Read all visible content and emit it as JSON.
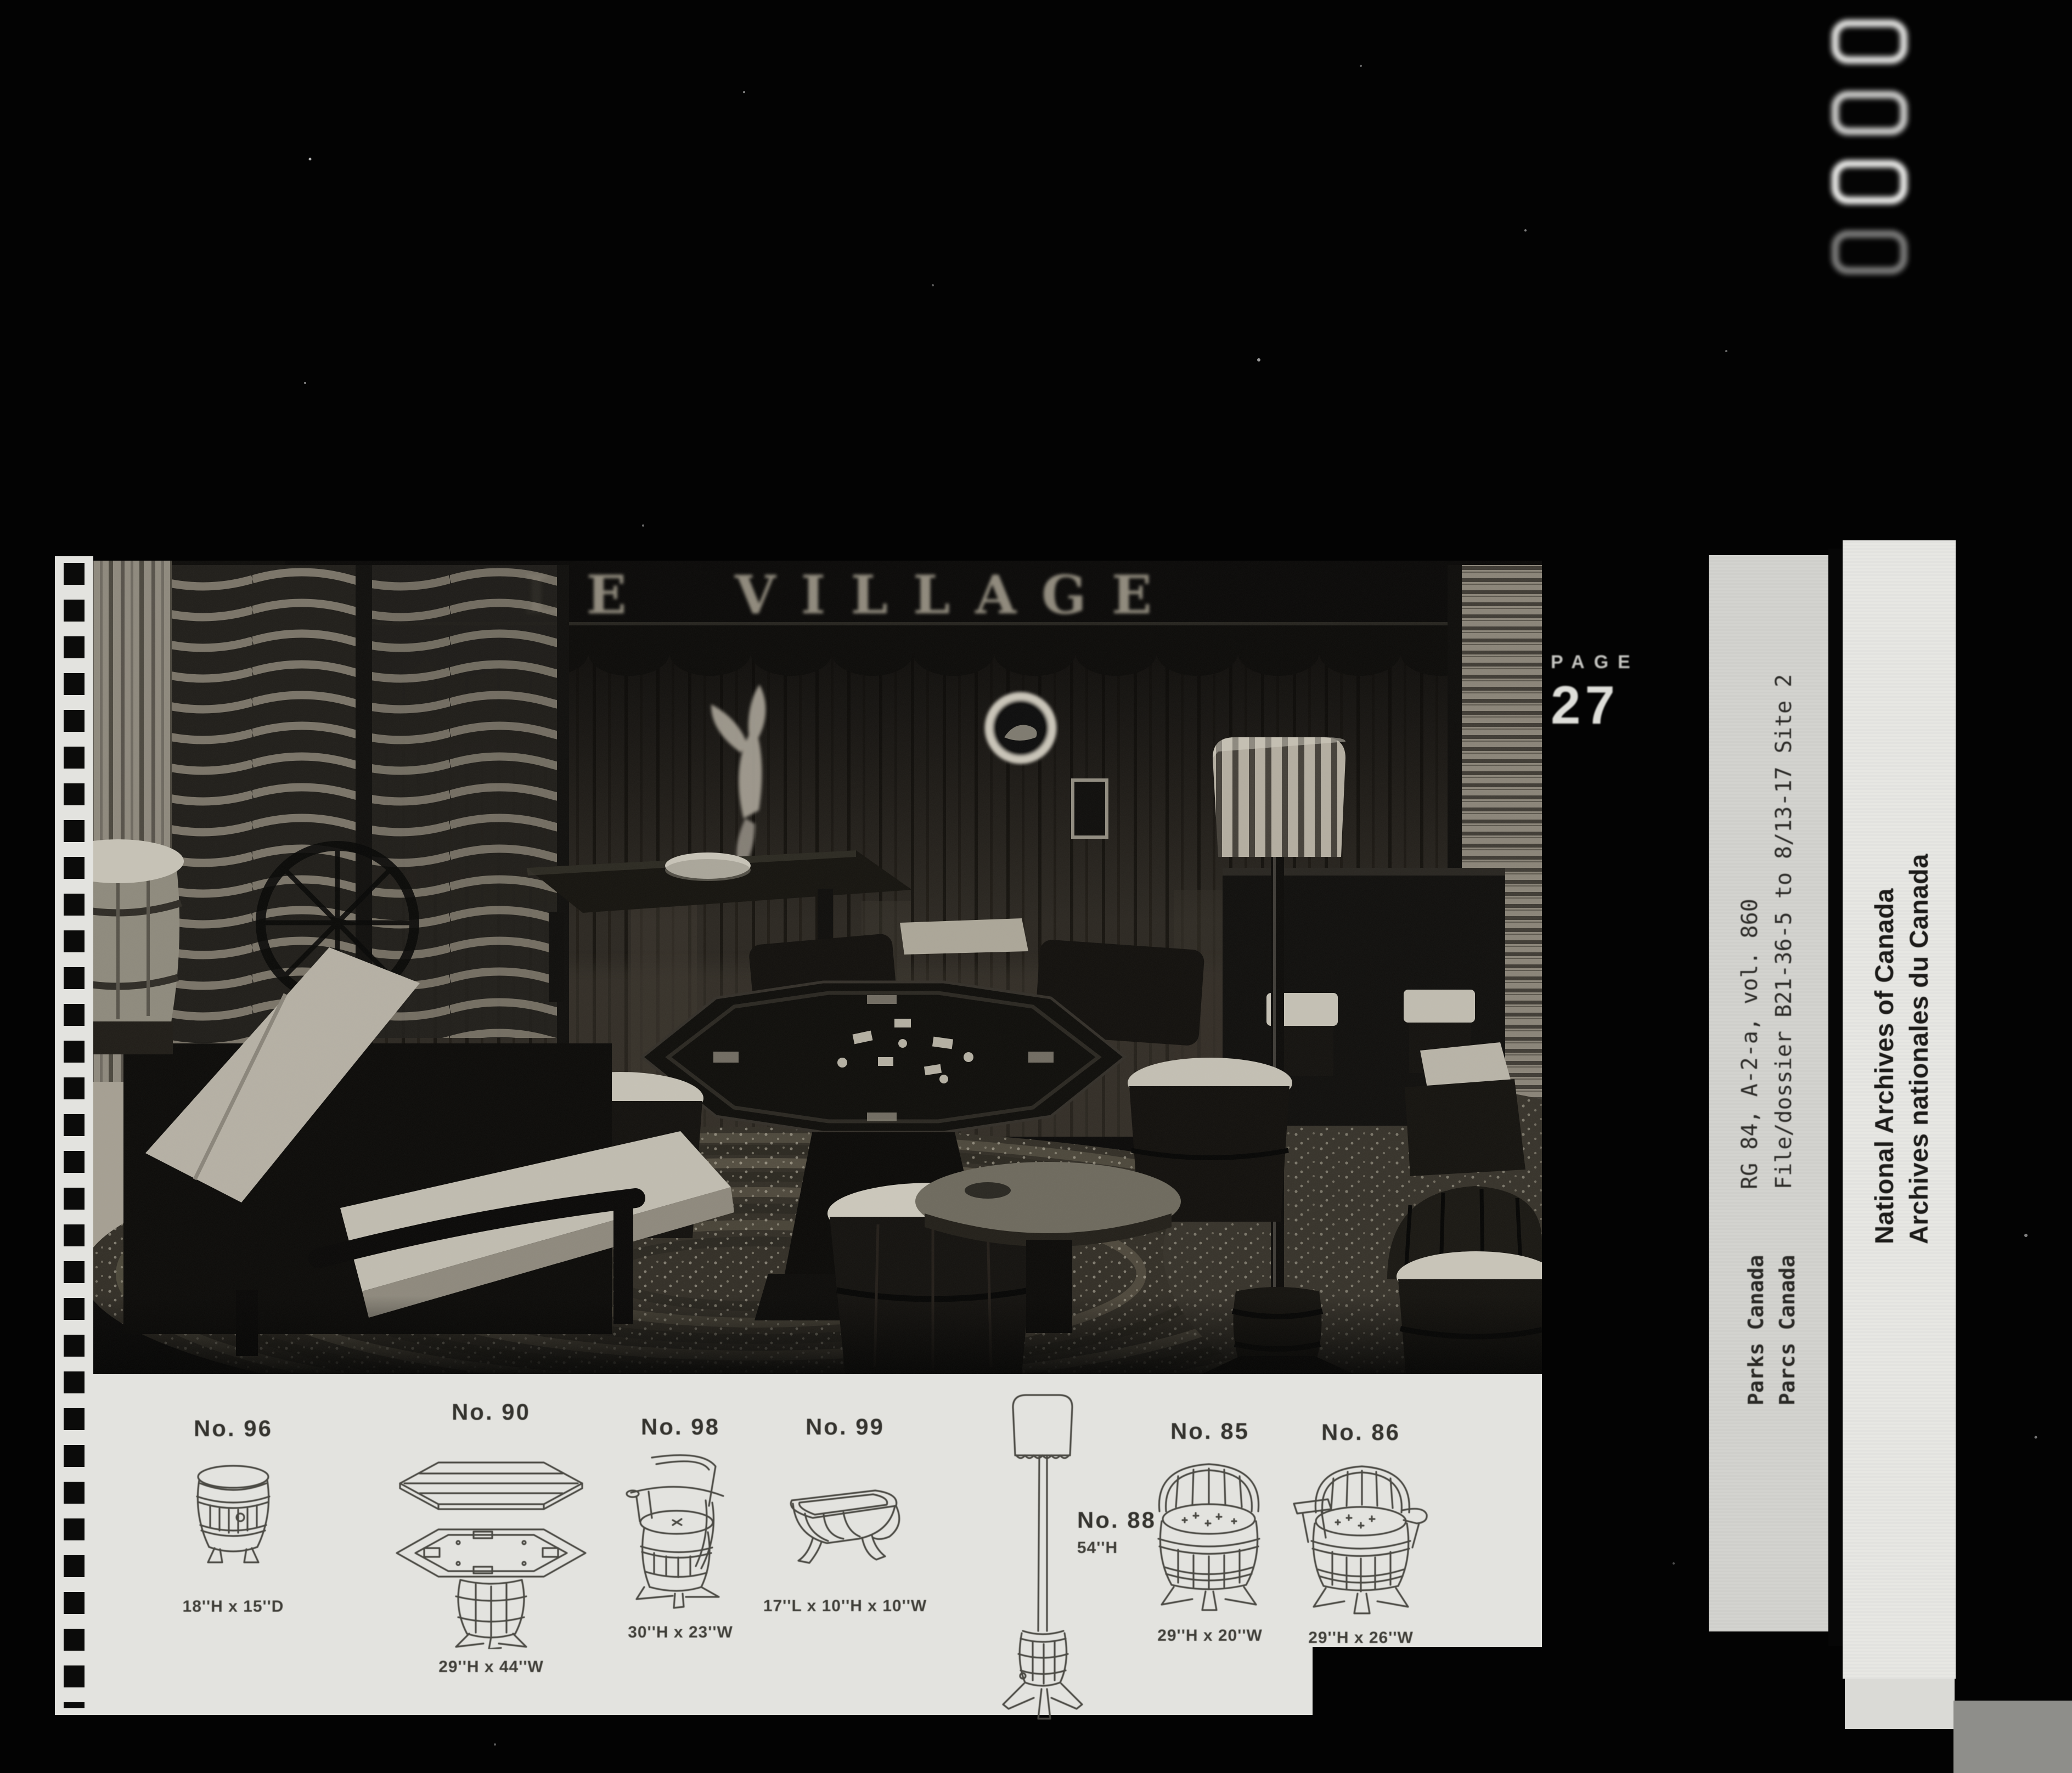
{
  "film": {
    "page_label": "PAGE",
    "page_number": "27",
    "counter_mark_count": 4
  },
  "photo": {
    "sign_text": "LE VILLAGE"
  },
  "catalog": {
    "items": [
      {
        "id": "No. 96",
        "dims": "18''H x 15''D",
        "type": "barrel-end-table"
      },
      {
        "id": "No. 90",
        "dims": "29''H x 44''W",
        "type": "octagonal-game-table"
      },
      {
        "id": "No. 98",
        "dims": "30''H x 23''W",
        "type": "barrel-captain-chair"
      },
      {
        "id": "No. 99",
        "dims": "17''L x 10''H x 10''W",
        "type": "half-barrel-table"
      },
      {
        "id": "No. 88",
        "dims": "54''H",
        "type": "barrel-floor-lamp"
      },
      {
        "id": "No. 85",
        "dims": "29''H x 20''W",
        "type": "barrel-tub-chair"
      },
      {
        "id": "No. 86",
        "dims": "29''H x 26''W",
        "type": "barrel-arm-chair"
      }
    ]
  },
  "side_labels": {
    "reference_line1": "RG 84, A-2-a, vol. 860",
    "reference_line2": "File/dossier B21-36-5 to 8/13-17 Site 2",
    "agency_line1": "Parks Canada",
    "agency_line2": "Parcs Canada",
    "institution_line1": "National Archives of Canada",
    "institution_line2": "Archives nationales du Canada"
  },
  "colors": {
    "paper": "#e3e3df",
    "reference_paper": "#d3d3cf",
    "institution_paper": "#e7e7e3",
    "film_black": "#050505"
  }
}
